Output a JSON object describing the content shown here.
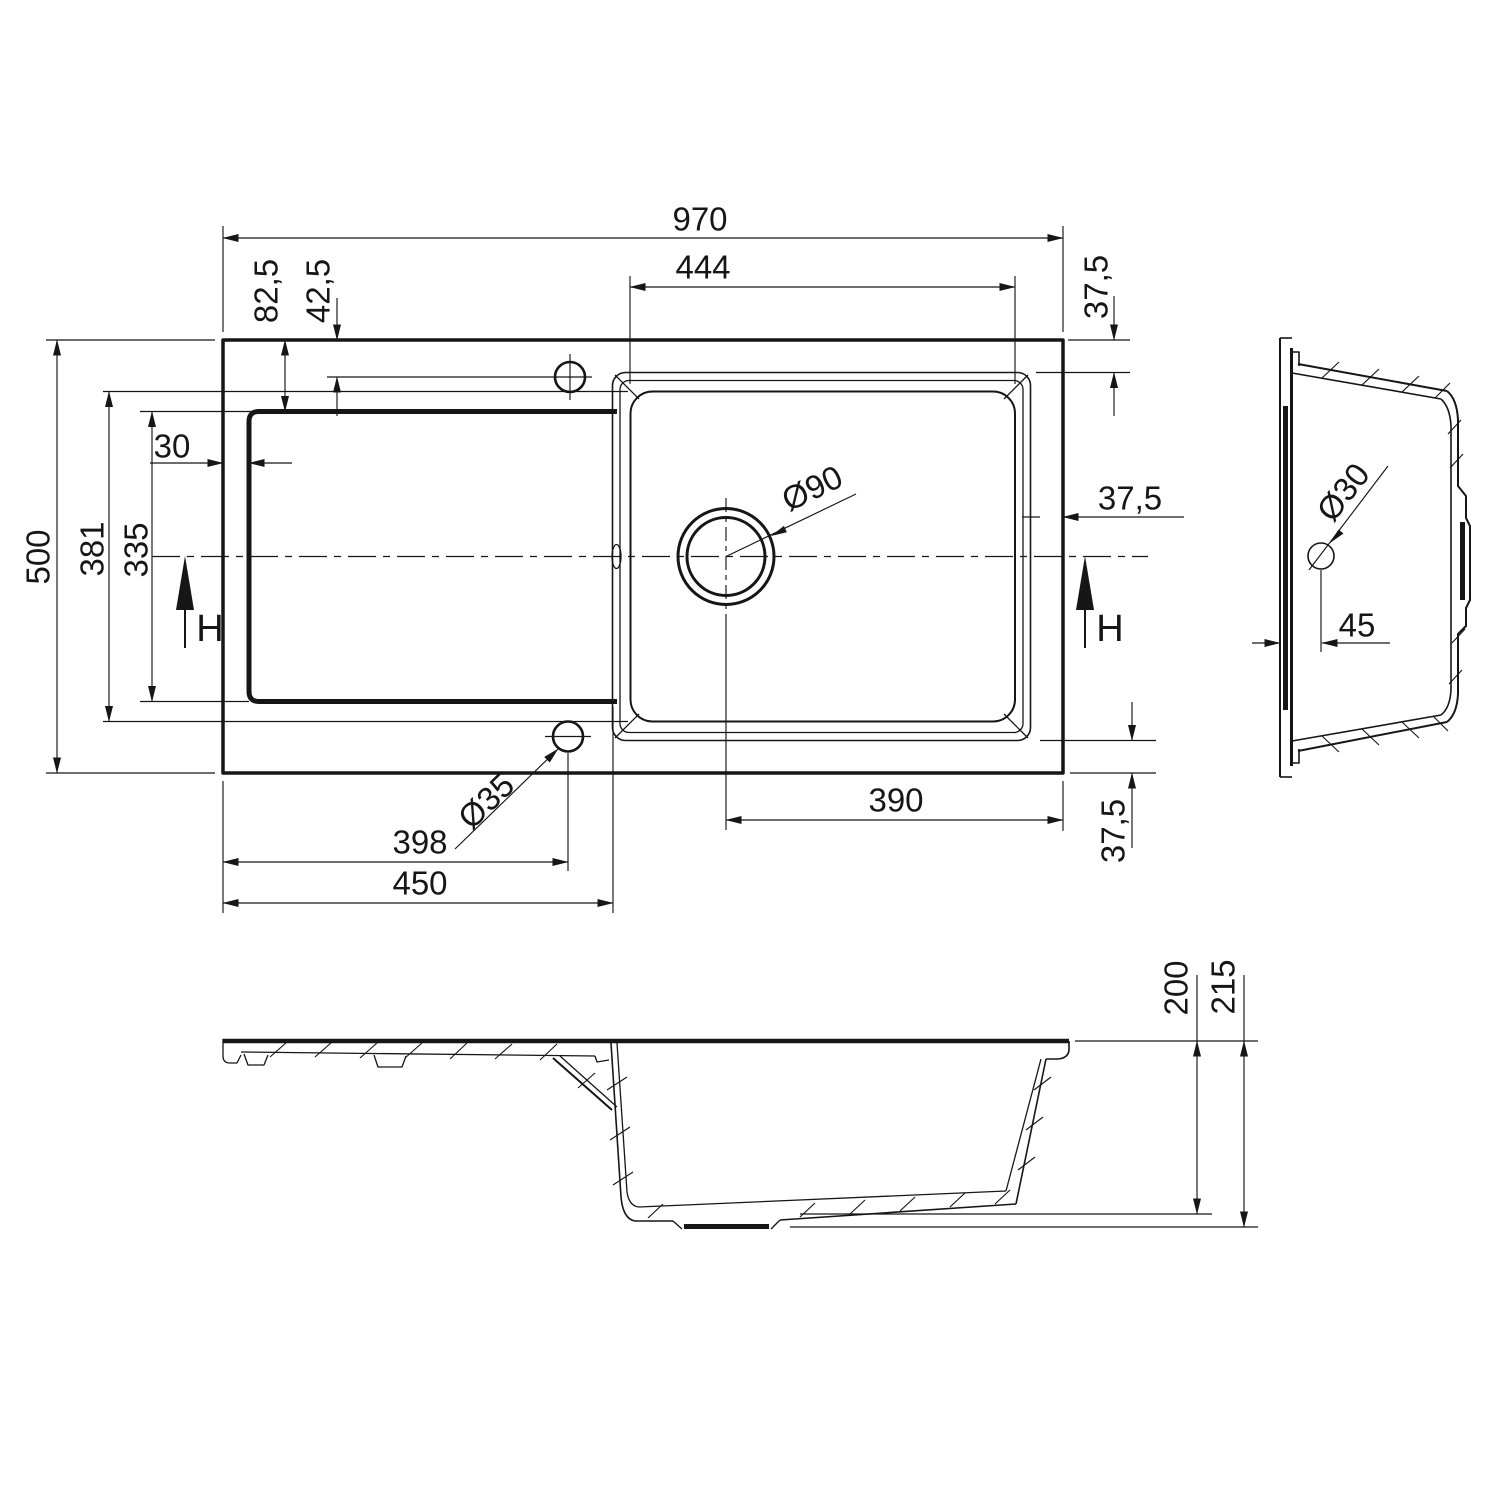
{
  "plan": {
    "overall_width": "970",
    "bowl_width": "444",
    "rim_top": "37,5",
    "rim_right": "37,5",
    "rim_bottom": "37,5",
    "hole_offset_a": "82,5",
    "hole_offset_b": "42,5",
    "overall_depth": "500",
    "bowl_depth": "381",
    "board_depth": "335",
    "board_gap": "30",
    "drain_dia": "Ø90",
    "hole_dia": "Ø35",
    "drain_offset": "390",
    "hole_x": "398",
    "board_width": "450",
    "h_left": "H",
    "h_right": "H"
  },
  "side": {
    "hole_dia": "Ø30",
    "hole_offset": "45"
  },
  "section": {
    "bowl_depth": "200",
    "overall_height": "215"
  }
}
